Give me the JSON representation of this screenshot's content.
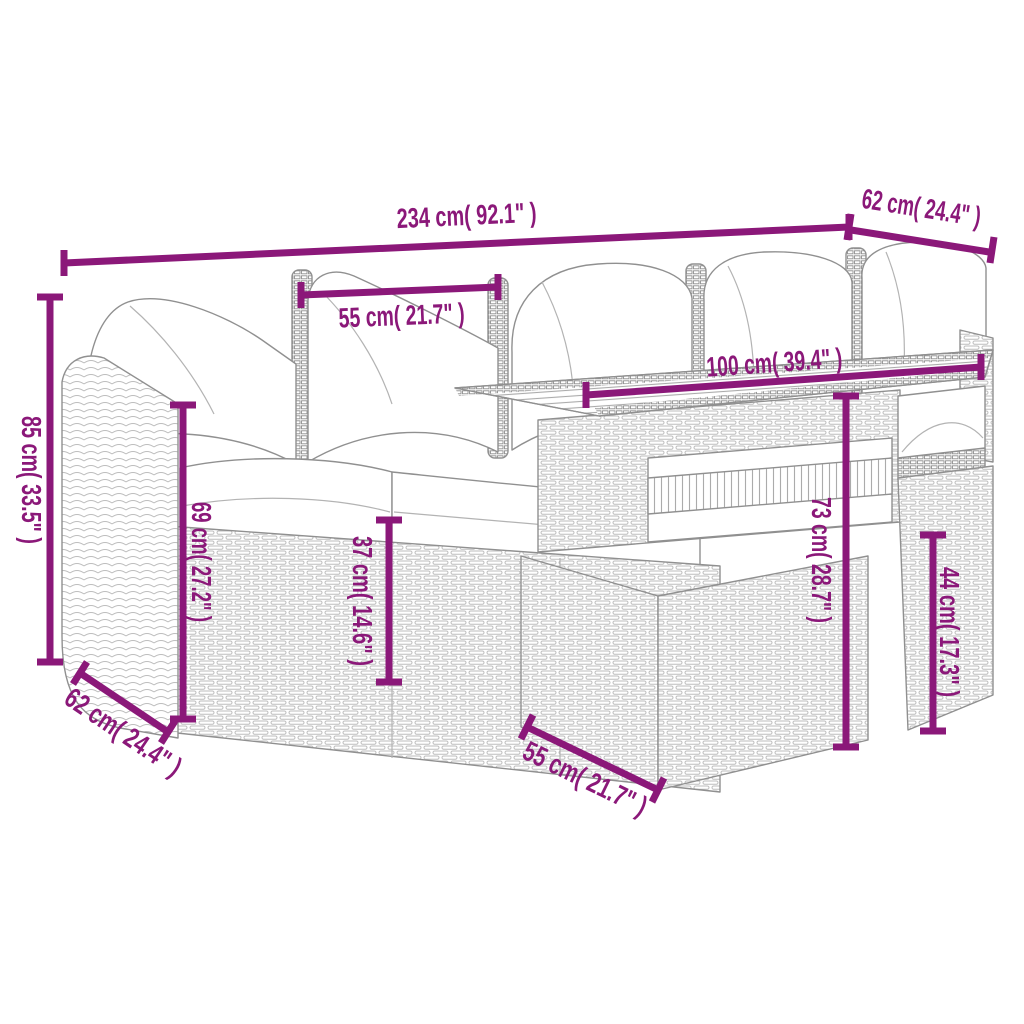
{
  "canvas": {
    "width": 1024,
    "height": 1024,
    "background": "#ffffff"
  },
  "style": {
    "dimension_color": "#8B1879",
    "outline_color": "#909090",
    "weave_color": "#bdbdbd",
    "cushion_color": "#ffffff"
  },
  "figure": {
    "name": "garden-furniture-set-line-drawing"
  },
  "dimensions": {
    "total_width": {
      "label": "234 cm( 92.1\" )"
    },
    "depth_top_right": {
      "label": "62 cm( 24.4\" )"
    },
    "seat_width_top": {
      "label": "55 cm( 21.7\" )"
    },
    "table_length": {
      "label": "100 cm( 39.4\" )"
    },
    "total_height": {
      "label": "85 cm( 33.5\" )"
    },
    "back_height": {
      "label": "69 cm( 27.2\" )"
    },
    "seat_height": {
      "label": "37 cm( 14.6\" )"
    },
    "table_height": {
      "label": "73 cm( 28.7\" )"
    },
    "side_seat_height": {
      "label": "44 cm( 17.3\" )"
    },
    "depth_bottom_left": {
      "label": "62 cm( 24.4\" )"
    },
    "table_base_width": {
      "label": "55 cm( 21.7\" )"
    }
  }
}
